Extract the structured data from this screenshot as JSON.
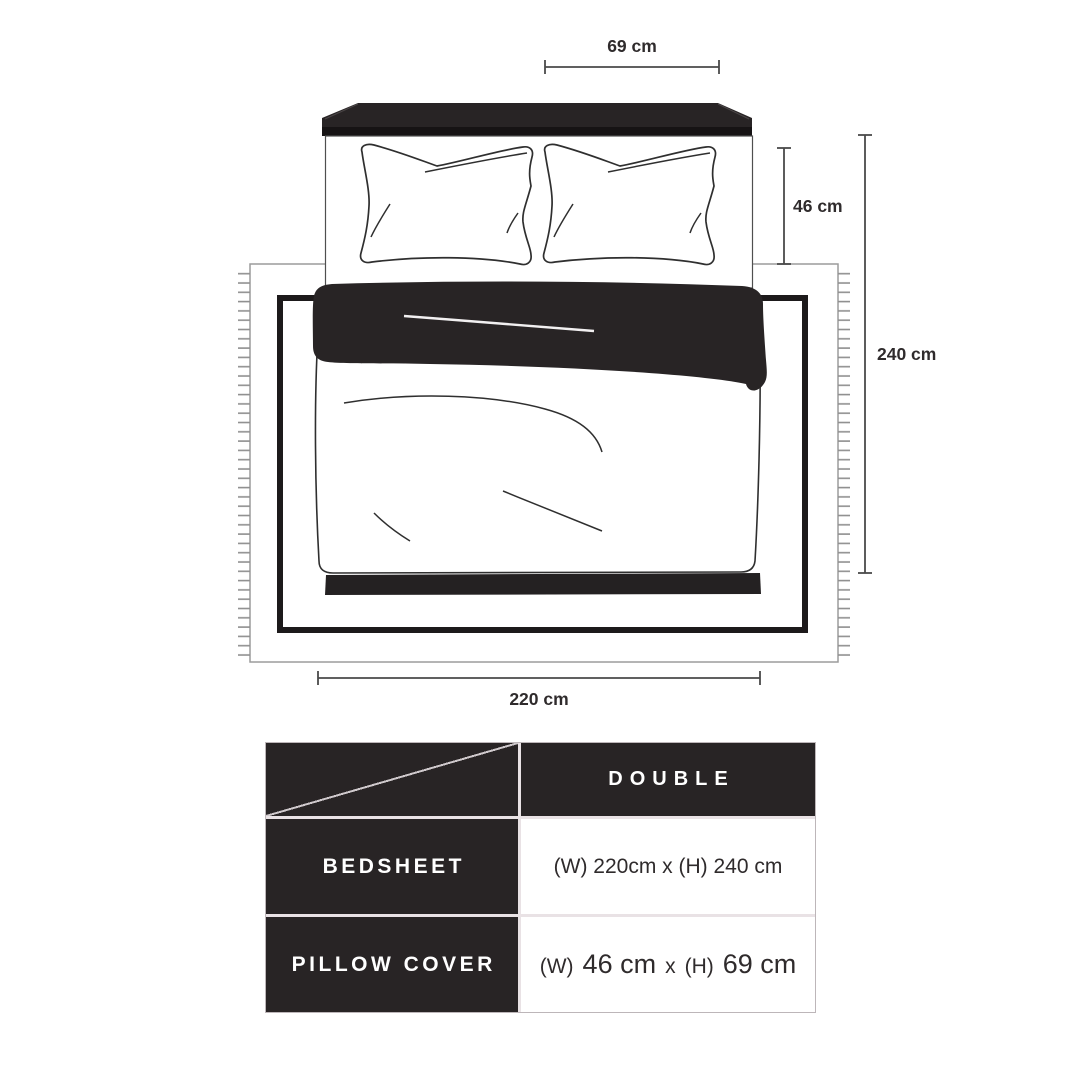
{
  "diagram": {
    "dimension_labels": {
      "pillow_width": "69 cm",
      "pillow_height": "46 cm",
      "bedsheet_height": "240 cm",
      "bedsheet_width": "220 cm"
    }
  },
  "size_table": {
    "column_header": "DOUBLE",
    "rows": [
      {
        "label": "BEDSHEET",
        "value": "(W) 220cm x (H) 240 cm"
      },
      {
        "label": "PILLOW COVER",
        "value_w_label": "(W)",
        "value_w": "46 cm",
        "value_sep": "x",
        "value_h_label": "(H)",
        "value_h": "69 cm"
      }
    ]
  },
  "colors": {
    "dark": "#282425",
    "dimension_line": "#4a4a4a",
    "table_gap": "#e9e2e5"
  }
}
